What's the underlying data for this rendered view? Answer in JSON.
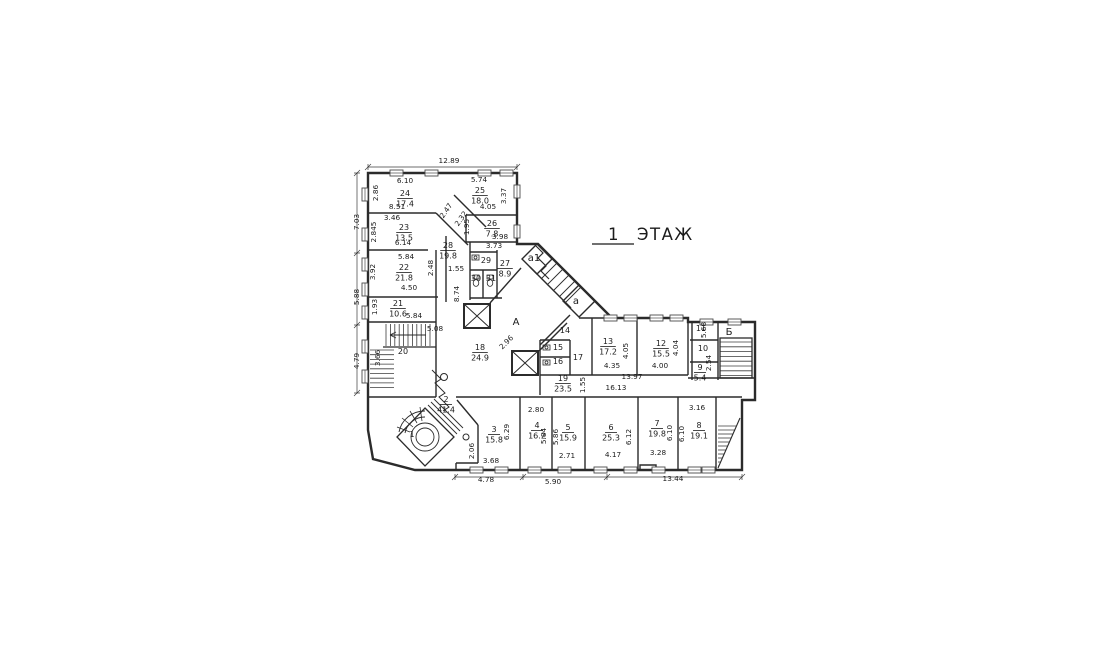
{
  "title": {
    "floor_number": "1",
    "floor_word": "ЭТАЖ"
  },
  "colors": {
    "wall": "#2b2b2b",
    "thin": "#3c3c3c",
    "text": "#1b1b1b",
    "background": "#ffffff"
  },
  "plan": {
    "rooms": [
      {
        "no": "24",
        "area": "17.4",
        "x": 405,
        "y": 196
      },
      {
        "no": "25",
        "area": "18.0",
        "x": 480,
        "y": 193
      },
      {
        "no": "23",
        "area": "13.5",
        "x": 404,
        "y": 230
      },
      {
        "no": "26",
        "area": "7.8",
        "x": 492,
        "y": 226
      },
      {
        "no": "28",
        "area": "19.8",
        "x": 448,
        "y": 248
      },
      {
        "no": "22",
        "area": "21.8",
        "x": 404,
        "y": 270
      },
      {
        "no": "21",
        "area": "10.6",
        "x": 398,
        "y": 306
      },
      {
        "no": "20",
        "area": "",
        "x": 403,
        "y": 354
      },
      {
        "no": "29",
        "area": "",
        "x": 486,
        "y": 263
      },
      {
        "no": "30",
        "area": "",
        "x": 476,
        "y": 281
      },
      {
        "no": "31",
        "area": "",
        "x": 491,
        "y": 281
      },
      {
        "no": "27",
        "area": "8.9",
        "x": 505,
        "y": 266
      },
      {
        "no": "18",
        "area": "24.9",
        "x": 480,
        "y": 350
      },
      {
        "no": "14",
        "area": "",
        "x": 565,
        "y": 333
      },
      {
        "no": "15",
        "area": "",
        "x": 558,
        "y": 350
      },
      {
        "no": "16",
        "area": "",
        "x": 558,
        "y": 364
      },
      {
        "no": "17",
        "area": "",
        "x": 578,
        "y": 360
      },
      {
        "no": "19",
        "area": "23.5",
        "x": 563,
        "y": 381
      },
      {
        "no": "13",
        "area": "17.2",
        "x": 608,
        "y": 344
      },
      {
        "no": "12",
        "area": "15.5",
        "x": 661,
        "y": 346
      },
      {
        "no": "11",
        "area": "",
        "x": 701,
        "y": 331
      },
      {
        "no": "10",
        "area": "",
        "x": 703,
        "y": 351
      },
      {
        "no": "9",
        "area": "5.4",
        "x": 700,
        "y": 370
      },
      {
        "no": "8",
        "area": "19.1",
        "x": 699,
        "y": 428
      },
      {
        "no": "7",
        "area": "19.8",
        "x": 657,
        "y": 426
      },
      {
        "no": "6",
        "area": "25.3",
        "x": 611,
        "y": 430
      },
      {
        "no": "5",
        "area": "15.9",
        "x": 568,
        "y": 430
      },
      {
        "no": "4",
        "area": "16.2",
        "x": 537,
        "y": 428
      },
      {
        "no": "3",
        "area": "15.8",
        "x": 494,
        "y": 432
      },
      {
        "no": "2",
        "area": "41.4",
        "x": 446,
        "y": 402
      },
      {
        "no": "1",
        "area": "",
        "x": 412,
        "y": 437
      }
    ],
    "section_labels": [
      {
        "t": "А",
        "x": 516,
        "y": 325
      },
      {
        "t": "Б",
        "x": 729,
        "y": 335
      },
      {
        "t": "а",
        "x": 576,
        "y": 304
      },
      {
        "t": "а1",
        "x": 534,
        "y": 261
      }
    ],
    "dimensions": [
      {
        "t": "12.89",
        "x": 449,
        "y": 163,
        "r": 0
      },
      {
        "t": "7.03",
        "x": 359,
        "y": 222,
        "r": -90
      },
      {
        "t": "2.86",
        "x": 378,
        "y": 193,
        "r": -90
      },
      {
        "t": "6.10",
        "x": 405,
        "y": 183,
        "r": 0
      },
      {
        "t": "8.51",
        "x": 397,
        "y": 209,
        "r": 0
      },
      {
        "t": "5.74",
        "x": 479,
        "y": 182,
        "r": 0
      },
      {
        "t": "3.37",
        "x": 506,
        "y": 196,
        "r": -90
      },
      {
        "t": "4.05",
        "x": 488,
        "y": 209,
        "r": 0
      },
      {
        "t": "3.46",
        "x": 392,
        "y": 220,
        "r": 0
      },
      {
        "t": "2.845",
        "x": 376,
        "y": 232,
        "r": -90
      },
      {
        "t": "6.14",
        "x": 403,
        "y": 245,
        "r": 0
      },
      {
        "t": "2.47",
        "x": 448,
        "y": 212,
        "r": -55
      },
      {
        "t": "2.32",
        "x": 463,
        "y": 220,
        "r": -55
      },
      {
        "t": "1.95",
        "x": 469,
        "y": 227,
        "r": -90
      },
      {
        "t": "3.98",
        "x": 500,
        "y": 239,
        "r": 0
      },
      {
        "t": "3.73",
        "x": 494,
        "y": 248,
        "r": 0
      },
      {
        "t": "1.55",
        "x": 456,
        "y": 271,
        "r": 0
      },
      {
        "t": "8.74",
        "x": 459,
        "y": 294,
        "r": -90
      },
      {
        "t": "5.84",
        "x": 406,
        "y": 259,
        "r": 0
      },
      {
        "t": "3.92",
        "x": 375,
        "y": 272,
        "r": -90
      },
      {
        "t": "2.48",
        "x": 433,
        "y": 268,
        "r": -90
      },
      {
        "t": "4.50",
        "x": 409,
        "y": 290,
        "r": 0
      },
      {
        "t": "5.88",
        "x": 359,
        "y": 297,
        "r": -90
      },
      {
        "t": "1.93",
        "x": 377,
        "y": 307,
        "r": -90
      },
      {
        "t": "5.84",
        "x": 414,
        "y": 318,
        "r": 0
      },
      {
        "t": "5.08",
        "x": 435,
        "y": 331,
        "r": 0
      },
      {
        "t": "3.66",
        "x": 380,
        "y": 358,
        "r": -90
      },
      {
        "t": "4.79",
        "x": 359,
        "y": 361,
        "r": -90
      },
      {
        "t": "2.96",
        "x": 508,
        "y": 344,
        "r": -45
      },
      {
        "t": "16.13",
        "x": 616,
        "y": 390,
        "r": 0
      },
      {
        "t": "13.97",
        "x": 632,
        "y": 379,
        "r": 0
      },
      {
        "t": "1.55",
        "x": 585,
        "y": 385,
        "r": -90
      },
      {
        "t": "4.05",
        "x": 628,
        "y": 351,
        "r": -90
      },
      {
        "t": "4.35",
        "x": 612,
        "y": 368,
        "r": 0
      },
      {
        "t": "4.04",
        "x": 678,
        "y": 348,
        "r": -90
      },
      {
        "t": "4.00",
        "x": 660,
        "y": 368,
        "r": 0
      },
      {
        "t": "5.68",
        "x": 706,
        "y": 330,
        "r": -90
      },
      {
        "t": "2.54",
        "x": 711,
        "y": 363,
        "r": -90
      },
      {
        "t": "2.80",
        "x": 536,
        "y": 412,
        "r": 0
      },
      {
        "t": "6.29",
        "x": 509,
        "y": 432,
        "r": -90
      },
      {
        "t": "5.84",
        "x": 546,
        "y": 436,
        "r": -90
      },
      {
        "t": "5.86",
        "x": 558,
        "y": 437,
        "r": -90
      },
      {
        "t": "6.12",
        "x": 631,
        "y": 437,
        "r": -90
      },
      {
        "t": "6.10",
        "x": 672,
        "y": 433,
        "r": -90
      },
      {
        "t": "6.10",
        "x": 684,
        "y": 434,
        "r": -90
      },
      {
        "t": "3.16",
        "x": 697,
        "y": 410,
        "r": 0
      },
      {
        "t": "2.06",
        "x": 474,
        "y": 451,
        "r": -90
      },
      {
        "t": "3.68",
        "x": 491,
        "y": 463,
        "r": 0
      },
      {
        "t": "2.71",
        "x": 567,
        "y": 458,
        "r": 0
      },
      {
        "t": "4.17",
        "x": 613,
        "y": 457,
        "r": 0
      },
      {
        "t": "3.28",
        "x": 658,
        "y": 455,
        "r": 0
      },
      {
        "t": "4.78",
        "x": 486,
        "y": 482,
        "r": 0
      },
      {
        "t": "5.90",
        "x": 553,
        "y": 484,
        "r": 0
      },
      {
        "t": "13.44",
        "x": 673,
        "y": 481,
        "r": 0
      }
    ]
  }
}
